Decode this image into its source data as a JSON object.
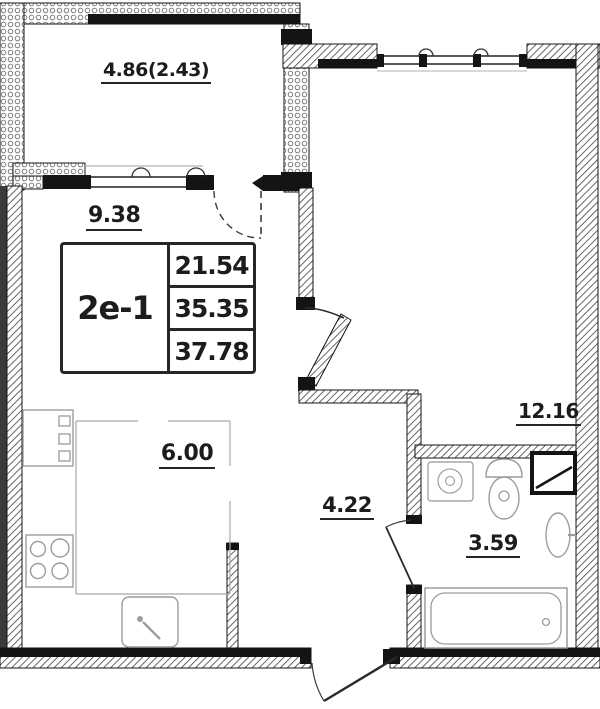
{
  "plan": {
    "labels": {
      "balcony": "4.86(2.43)",
      "living": "9.38",
      "kitchen": "6.00",
      "room": "12.16",
      "hall": "4.22",
      "bath": "3.59"
    },
    "stamp": {
      "type": "2e-1",
      "areas": [
        "21.54",
        "35.35",
        "37.78"
      ]
    },
    "colors": {
      "wall_line": "#151515",
      "fixture_line": "#9c9c9c",
      "zone_line": "#a8a8a8",
      "background": "#ffffff"
    }
  }
}
